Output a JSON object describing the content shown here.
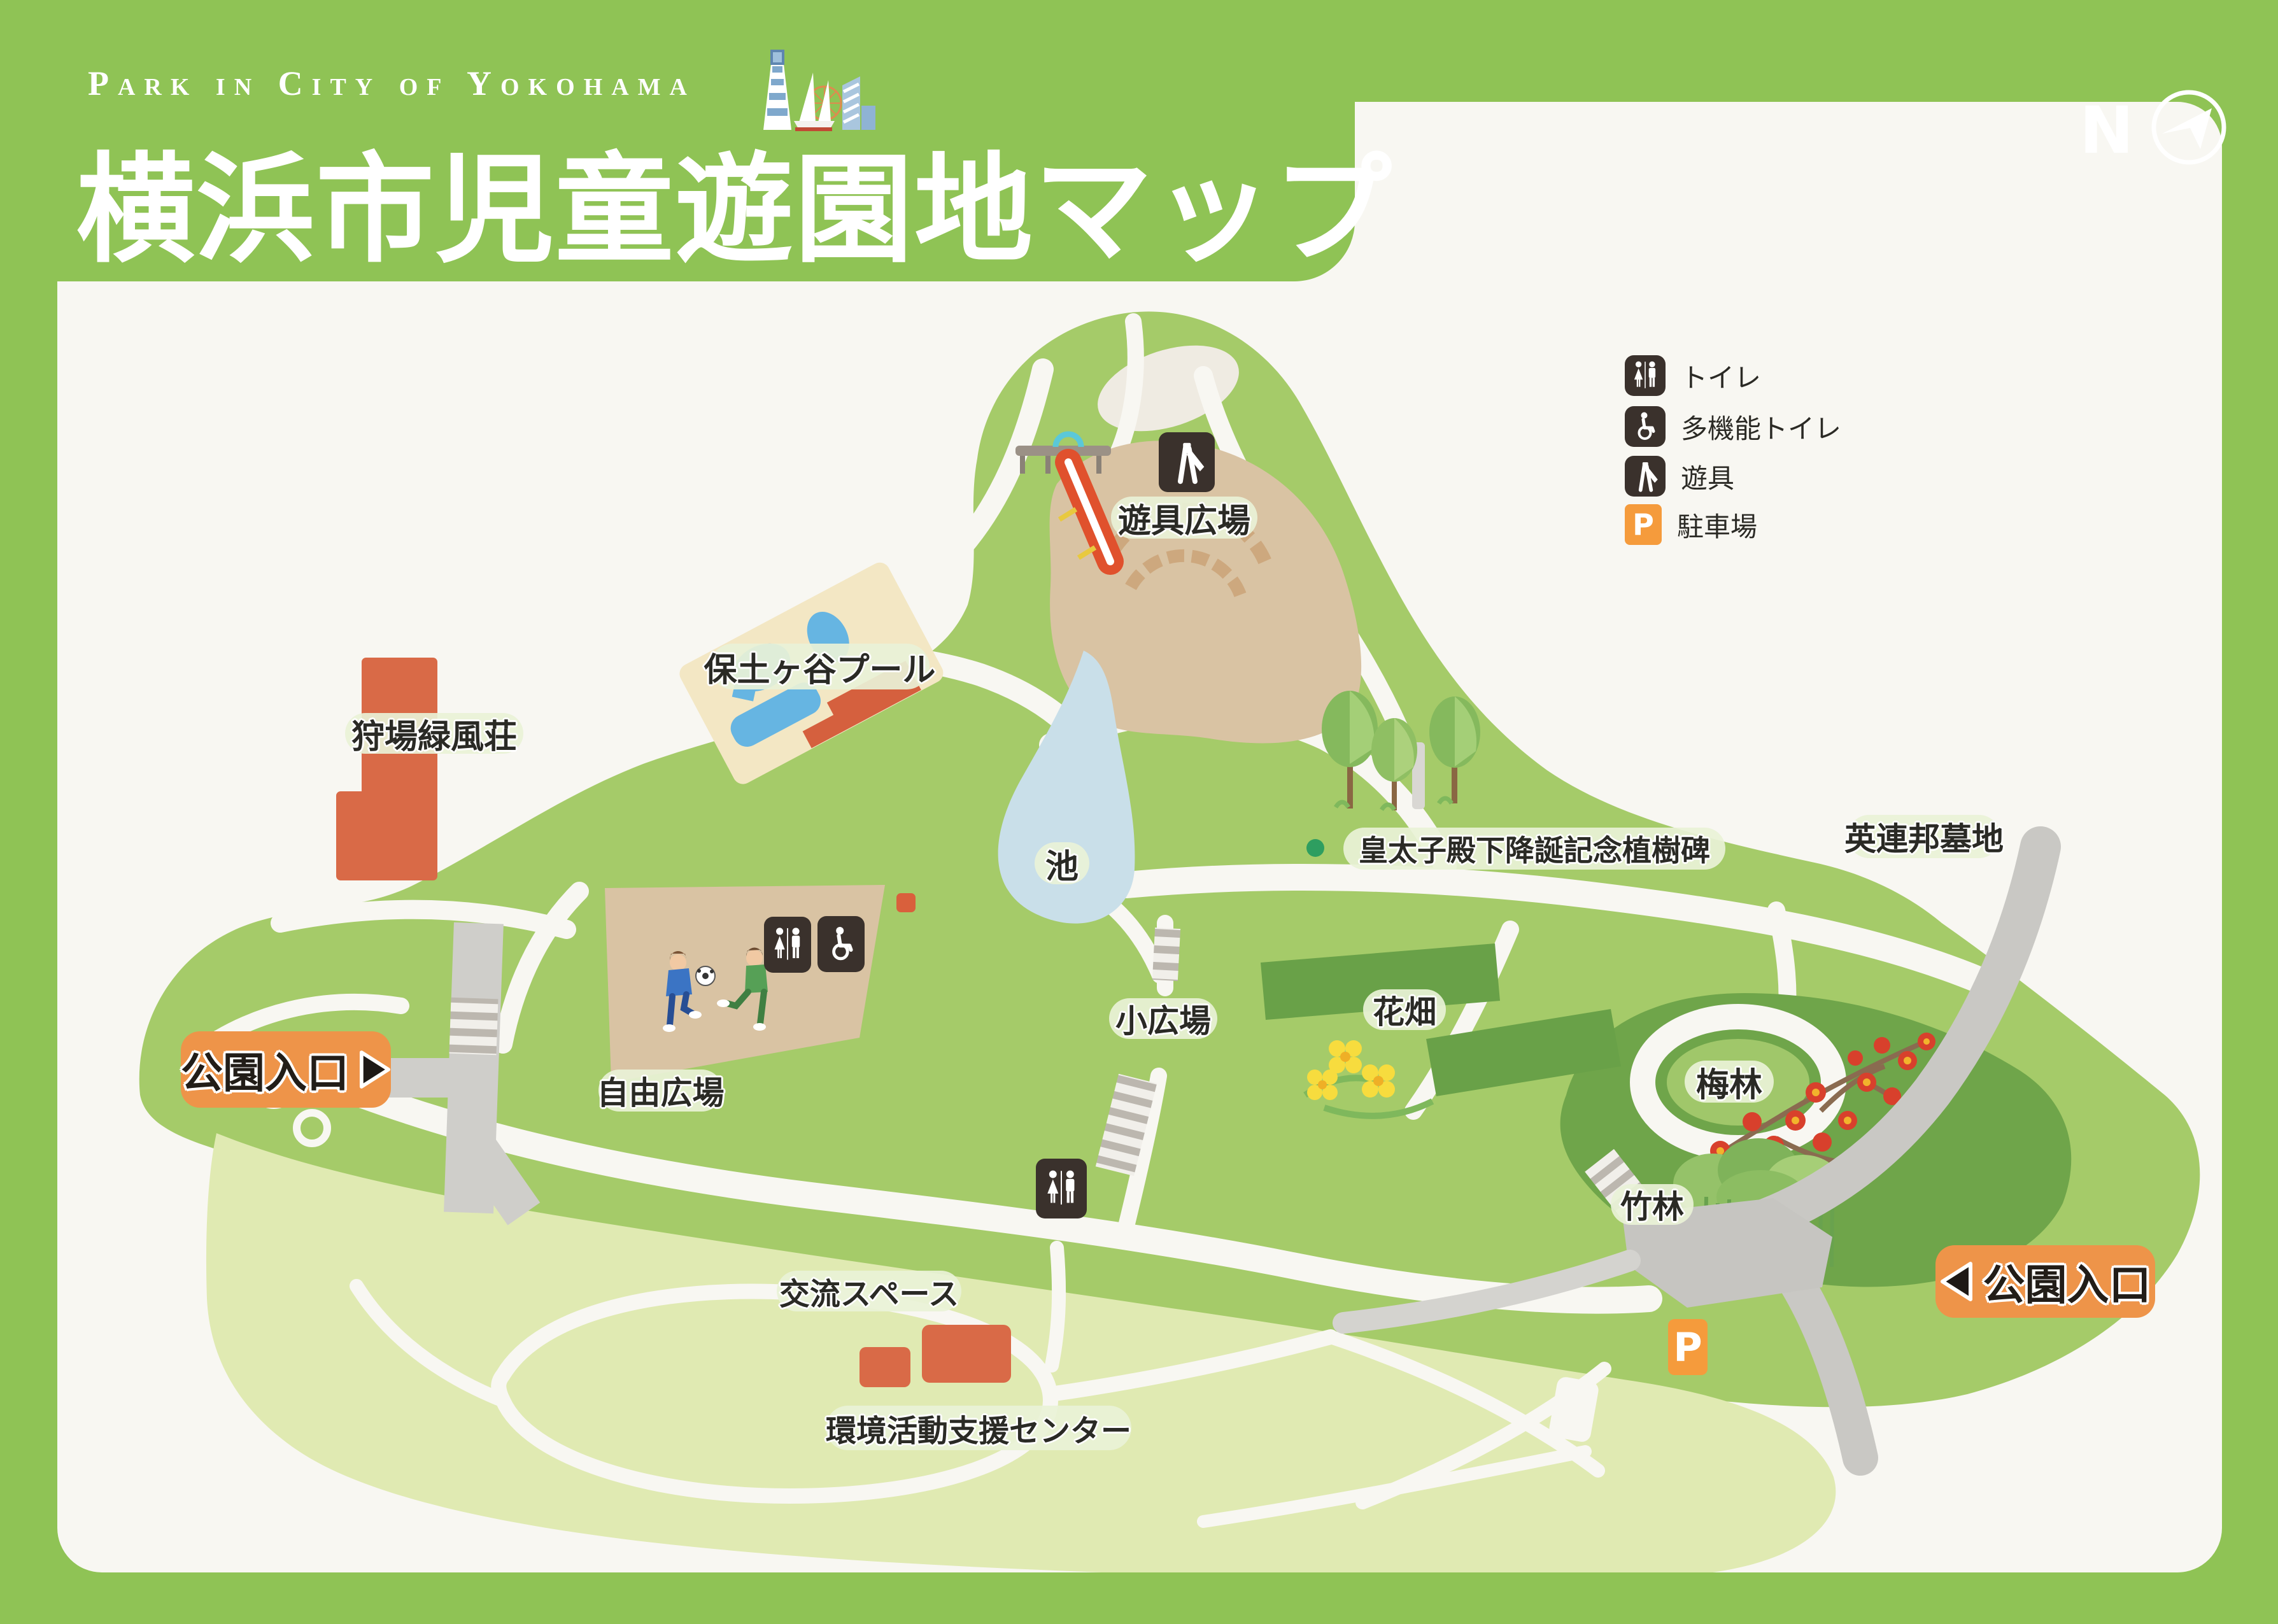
{
  "header": {
    "subtitle": "Park in City of Yokohama",
    "title": "横浜市児童遊園地マップ",
    "logo": "yokohama-landmarks-illustration"
  },
  "compass": {
    "north_label": "N"
  },
  "legend": {
    "items": [
      {
        "icon": "toilet-icon",
        "label": "トイレ"
      },
      {
        "icon": "accessible-toilet-icon",
        "label": "多機能トイレ"
      },
      {
        "icon": "playground-equipment-icon",
        "label": "遊具"
      },
      {
        "icon": "parking-icon",
        "label": "駐車場"
      }
    ]
  },
  "entrances": {
    "left": "公園入口",
    "right": "公園入口"
  },
  "labels": {
    "playground": "遊具広場",
    "pool": "保土ヶ谷プール",
    "lodge": "狩場緑風荘",
    "pond": "池",
    "monument": "皇太子殿下降誕記念植樹碑",
    "cemetery": "英連邦墓地",
    "free_plaza": "自由広場",
    "small_plaza": "小広場",
    "flower_field": "花畑",
    "plum_grove": "梅林",
    "bamboo_grove": "竹林",
    "exchange_space": "交流スペース",
    "env_center": "環境活動支援センター"
  },
  "icons": {
    "parking_letter": "P"
  },
  "colors": {
    "frame_green": "#8FC355",
    "park_green": "#A5CB69",
    "lawn_green": "#E0EAB2",
    "dark_green": "#6FA54A",
    "pond_blue": "#C9DFE9",
    "building_orange": "#D96A47",
    "accent_orange": "#EE9449",
    "parking_orange": "#F59B3C",
    "icon_dark": "#3A312C"
  }
}
